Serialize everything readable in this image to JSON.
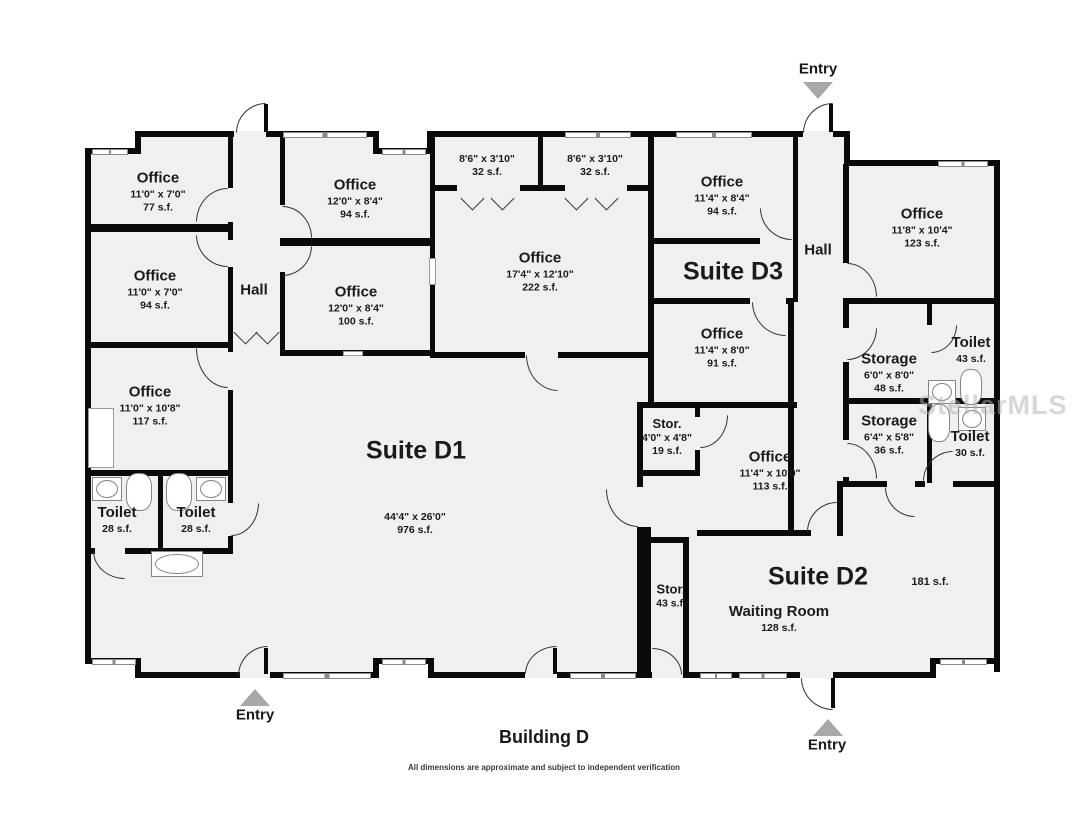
{
  "building": {
    "title": "Building D",
    "disclaimer": "All dimensions are approximate and subject to independent verification"
  },
  "watermark": "StellarMLS",
  "entries": {
    "top": "Entry",
    "bottom_left": "Entry",
    "bottom_right": "Entry"
  },
  "halls": {
    "left": "Hall",
    "right": "Hall"
  },
  "suites": {
    "d1": {
      "name": "Suite D1",
      "dims": "44'4\" x 26'0\"",
      "area": "976 s.f."
    },
    "d2": {
      "name": "Suite D2",
      "area": "181 s.f."
    },
    "d3": {
      "name": "Suite D3"
    }
  },
  "rooms": {
    "office_77": {
      "label": "Office",
      "dims": "11'0\" x 7'0\"",
      "area": "77 s.f."
    },
    "office_94a": {
      "label": "Office",
      "dims": "11'0\" x 7'0\"",
      "area": "94 s.f."
    },
    "office_117": {
      "label": "Office",
      "dims": "11'0\" x 10'8\"",
      "area": "117 s.f."
    },
    "toilet_28a": {
      "label": "Toilet",
      "area": "28 s.f."
    },
    "toilet_28b": {
      "label": "Toilet",
      "area": "28 s.f."
    },
    "office_94b": {
      "label": "Office",
      "dims": "12'0\" x 8'4\"",
      "area": "94 s.f."
    },
    "office_100": {
      "label": "Office",
      "dims": "12'0\" x 8'4\"",
      "area": "100 s.f."
    },
    "closet_32a": {
      "dims": "8'6\" x 3'10\"",
      "area": "32 s.f."
    },
    "closet_32b": {
      "dims": "8'6\" x 3'10\"",
      "area": "32 s.f."
    },
    "office_222": {
      "label": "Office",
      "dims": "17'4\" x 12'10\"",
      "area": "222 s.f."
    },
    "office_94c": {
      "label": "Office",
      "dims": "11'4\" x 8'4\"",
      "area": "94 s.f."
    },
    "office_91": {
      "label": "Office",
      "dims": "11'4\" x 8'0\"",
      "area": "91 s.f."
    },
    "office_123": {
      "label": "Office",
      "dims": "11'8\" x 10'4\"",
      "area": "123 s.f."
    },
    "storage_48": {
      "label": "Storage",
      "dims": "6'0\" x 8'0\"",
      "area": "48 s.f."
    },
    "toilet_43": {
      "label": "Toilet",
      "area": "43 s.f."
    },
    "storage_36": {
      "label": "Storage",
      "dims": "6'4\" x 5'8\"",
      "area": "36 s.f."
    },
    "toilet_30": {
      "label": "Toilet",
      "area": "30 s.f."
    },
    "stor_19": {
      "label": "Stor.",
      "dims": "4'0\" x 4'8\"",
      "area": "19 s.f."
    },
    "office_113": {
      "label": "Office",
      "dims": "11'4\" x 10'0\"",
      "area": "113 s.f."
    },
    "stor_43": {
      "label": "Stor.",
      "area": "43 s.f."
    },
    "waiting_room": {
      "label": "Waiting Room",
      "area": "128 s.f."
    }
  },
  "colors": {
    "wall": "#0a0a0a",
    "floor": "#f0f0f0",
    "entry_arrow": "#a8a8a8",
    "watermark": "#afafaf"
  }
}
